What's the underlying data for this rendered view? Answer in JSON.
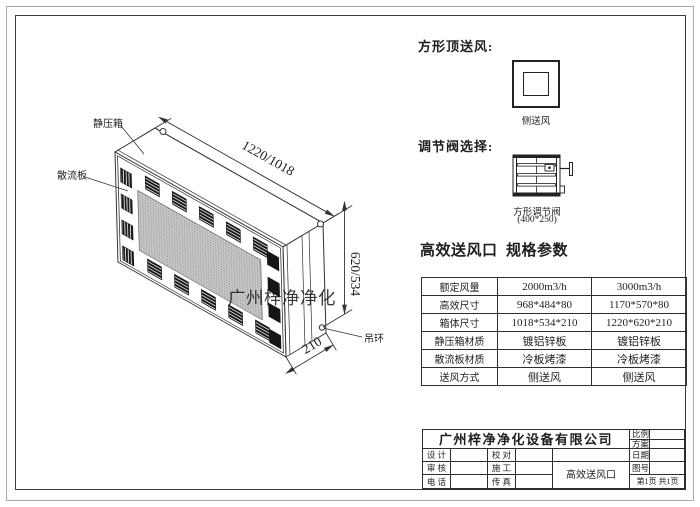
{
  "drawing": {
    "label_static_box": "静压箱",
    "label_diffuser": "散流板",
    "label_ring": "吊环",
    "dim_width": "1220/1018",
    "dim_height": "620/534",
    "dim_depth": "210",
    "watermark": "广州梓净净化"
  },
  "panel": {
    "top_supply_heading": "方形顶送风:",
    "top_supply_caption": "侧送风",
    "valve_heading": "调节阀选择:",
    "valve_caption1": "方形调节阀",
    "valve_caption2": "(400*250)",
    "spec_title": "高效送风口  规格参数",
    "spec": {
      "rows": [
        {
          "label": "额定风量",
          "v1": "2000m3/h",
          "v2": "3000m3/h"
        },
        {
          "label": "高效尺寸",
          "v1": "968*484*80",
          "v2": "1170*570*80"
        },
        {
          "label": "箱体尺寸",
          "v1": "1018*534*210",
          "v2": "1220*620*210"
        },
        {
          "label": "静压箱材质",
          "v1": "镀铝锌板",
          "v2": "镀铝锌板"
        },
        {
          "label": "散流板材质",
          "v1": "冷板烤漆",
          "v2": "冷板烤漆"
        },
        {
          "label": "送风方式",
          "v1": "侧送风",
          "v2": "侧送风"
        }
      ]
    }
  },
  "title_block": {
    "company": "广州梓净净化设备有限公司",
    "scale": "比例",
    "scheme": "方案",
    "design": "设 计",
    "check": "校 对",
    "date": "日期",
    "review": "审 核",
    "construct": "施 工",
    "drawing_no": "图号",
    "phone": "电 话",
    "fax": "传 真",
    "product": "高效送风口",
    "page": "第1页 共1页"
  },
  "colors": {
    "line": "#333333",
    "dark_grille": "#1a1a1a",
    "mesh_bg": "#c6c6c6",
    "mesh_dot": "#8a8a8a",
    "watermark_gray": "#8e8e8e"
  }
}
